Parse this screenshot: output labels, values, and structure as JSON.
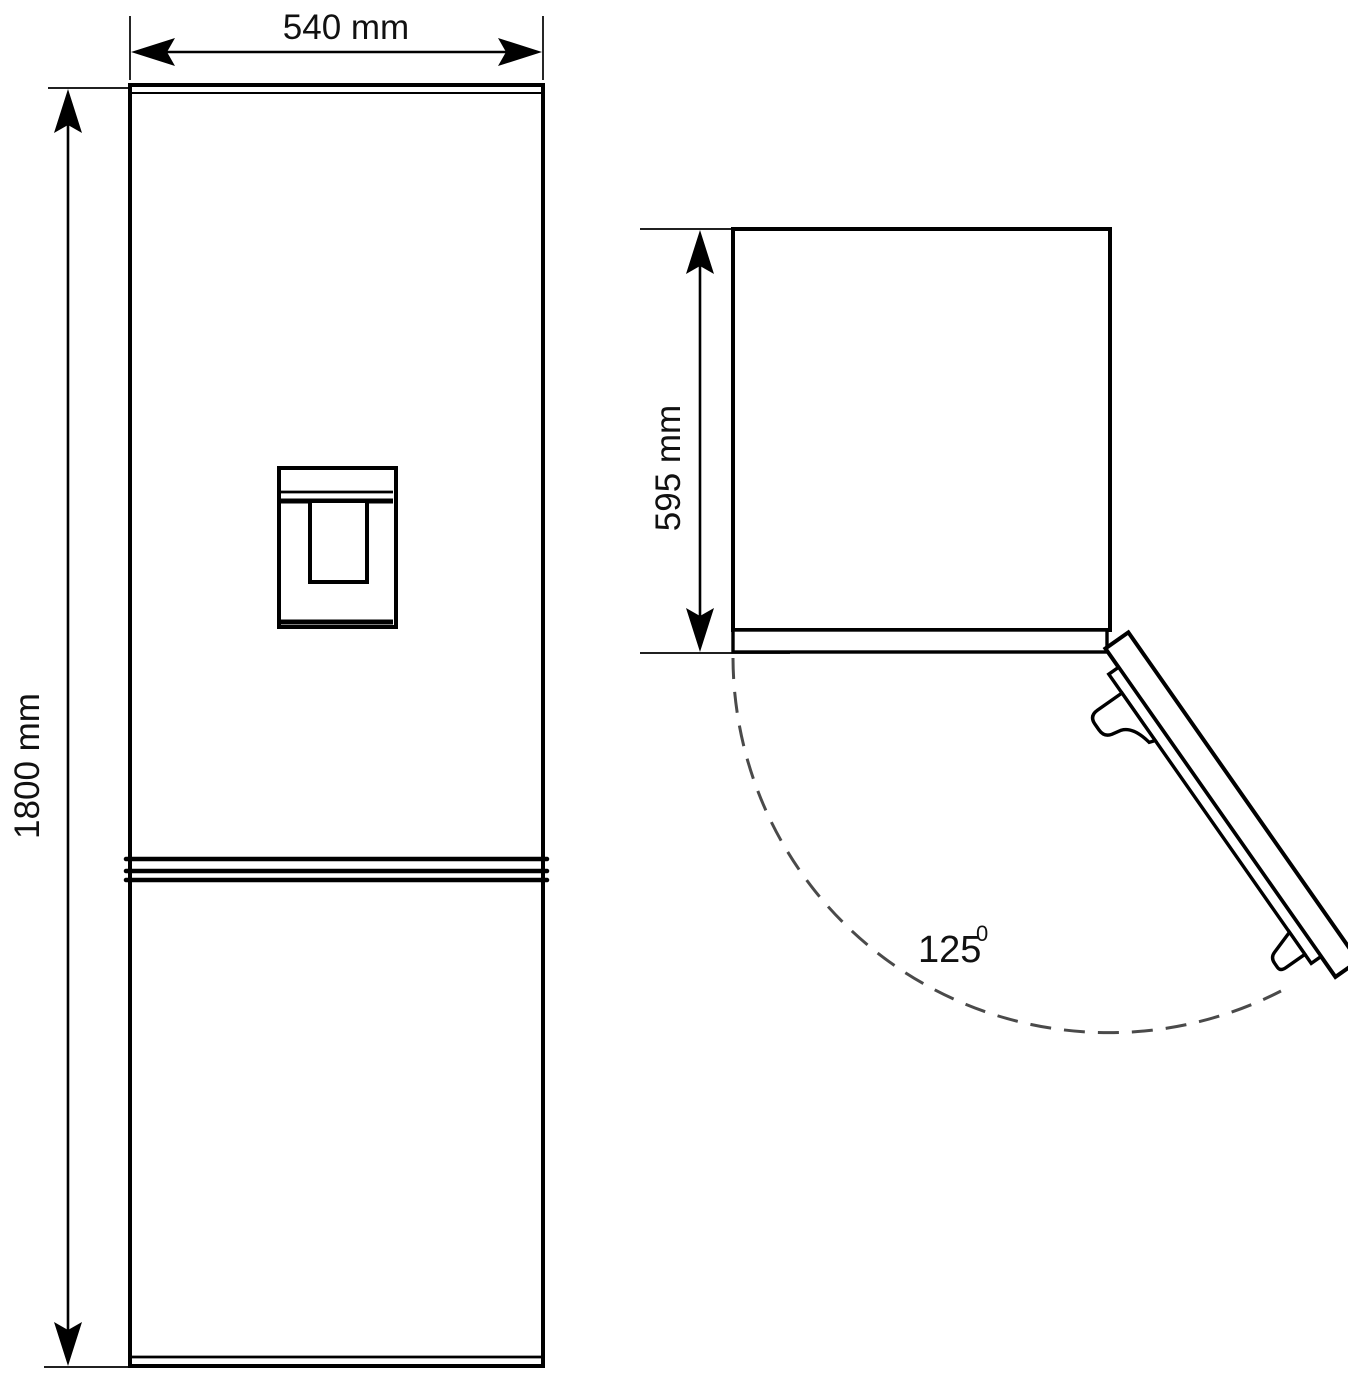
{
  "front_view": {
    "width_label": "540 mm",
    "height_label": "1800 mm"
  },
  "top_view": {
    "depth_label": "595 mm",
    "angle": {
      "value": "125",
      "superscript": "0"
    }
  },
  "colors": {
    "line": "#000000",
    "dash_arc": "#4a4a4a",
    "background": "#ffffff"
  }
}
